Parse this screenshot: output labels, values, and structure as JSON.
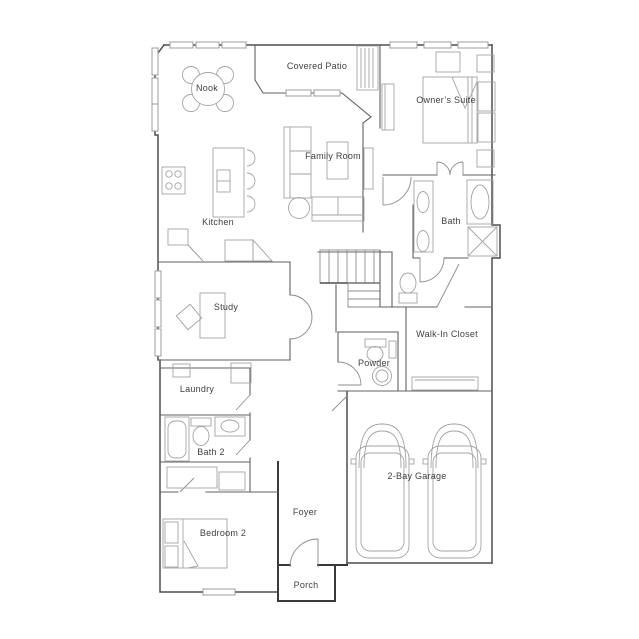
{
  "plan_type": "residential-floor-plan",
  "rooms": {
    "nook": {
      "label": "Nook"
    },
    "covered_patio": {
      "label": "Covered Patio"
    },
    "owners_suite": {
      "label": "Owner’s Suite"
    },
    "family_room": {
      "label": "Family Room"
    },
    "kitchen": {
      "label": "Kitchen"
    },
    "bath": {
      "label": "Bath"
    },
    "study": {
      "label": "Study"
    },
    "walk_in_closet": {
      "label": "Walk-In Closet"
    },
    "powder": {
      "label": "Powder"
    },
    "laundry": {
      "label": "Laundry"
    },
    "bath_2": {
      "label": "Bath 2"
    },
    "foyer": {
      "label": "Foyer"
    },
    "garage": {
      "label": "2-Bay Garage"
    },
    "bedroom_2": {
      "label": "Bedroom 2"
    },
    "porch": {
      "label": "Porch"
    }
  },
  "colors": {
    "background": "#ffffff",
    "exterior_wall": "#4f4f4f",
    "interior_wall": "#606060",
    "fixture_line": "#a3a3a3",
    "door_line": "#8d8d8d",
    "label_text": "#3f3f3f"
  }
}
